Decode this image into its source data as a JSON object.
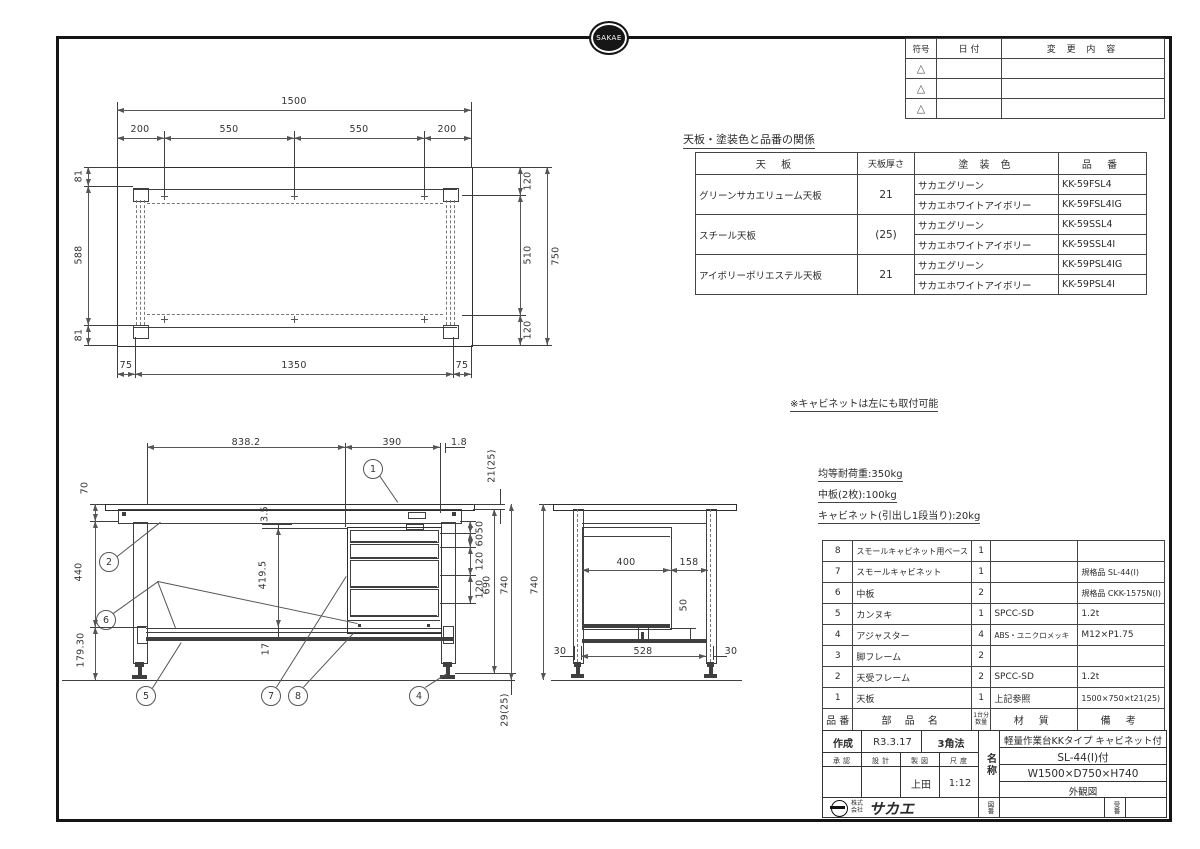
{
  "logo": {
    "text": "SAKAE",
    "company_prefix": "株式会社",
    "company_name": "サカエ"
  },
  "revision_table": {
    "col_symbol": "符号",
    "col_date": "日 付",
    "col_change": "変 更 内 容",
    "symbol": "△"
  },
  "paint_table": {
    "title": "天板・塗装色と品番の関係",
    "col_top": "天  板",
    "col_thickness": "天板厚さ",
    "col_color": "塗 装 色",
    "col_part_no": "品  番",
    "rows": [
      {
        "top_board": "グリーンサカエリューム天板",
        "thickness": "21",
        "color1": "サカエグリーン",
        "part1": "KK-59FSL4",
        "color2": "サカエホワイトアイボリー",
        "part2": "KK-59FSL4IG"
      },
      {
        "top_board": "スチール天板",
        "thickness": "(25)",
        "color1": "サカエグリーン",
        "part1": "KK-59SSL4",
        "color2": "サカエホワイトアイボリー",
        "part2": "KK-59SSL4I"
      },
      {
        "top_board": "アイボリーポリエステル天板",
        "thickness": "21",
        "color1": "サカエグリーン",
        "part1": "KK-59PSL4IG",
        "color2": "サカエホワイトアイボリー",
        "part2": "KK-59PSL4I"
      }
    ]
  },
  "notes": {
    "cabinet_note": "※キャビネットは左にも取付可能",
    "load_note1": "均等耐荷重:350kg",
    "load_note2": "中板(2枚):100kg",
    "load_note3": "キャビネット(引出し1段当り):20kg"
  },
  "parts_table": {
    "col_no": "品 番",
    "col_name": "部  品  名",
    "col_qty_top": "1台分",
    "col_qty_bottom": "数量",
    "col_material": "材  質",
    "col_remarks": "備  考",
    "rows": [
      {
        "no": "8",
        "name": "スモールキャビネット用ベース",
        "qty": "1",
        "material": "",
        "remarks": ""
      },
      {
        "no": "7",
        "name": "スモールキャビネット",
        "qty": "1",
        "material": "",
        "remarks": "規格品 SL-44(I)"
      },
      {
        "no": "6",
        "name": "中板",
        "qty": "2",
        "material": "",
        "remarks": "規格品 CKK-1575N(I)"
      },
      {
        "no": "5",
        "name": "カンヌキ",
        "qty": "1",
        "material": "SPCC-SD",
        "remarks": "1.2t"
      },
      {
        "no": "4",
        "name": "アジャスター",
        "qty": "4",
        "material": "ABS・ユニクロメッキ",
        "remarks": "M12×P1.75"
      },
      {
        "no": "3",
        "name": "脚フレーム",
        "qty": "2",
        "material": "",
        "remarks": ""
      },
      {
        "no": "2",
        "name": "天受フレーム",
        "qty": "2",
        "material": "SPCC-SD",
        "remarks": "1.2t"
      },
      {
        "no": "1",
        "name": "天板",
        "qty": "1",
        "material": "上記参照",
        "remarks": "1500×750×t21(25)"
      }
    ]
  },
  "title_block": {
    "created_label": "作成",
    "created_value": "R3.3.17",
    "projection": "3角法",
    "approve_label": "承認",
    "design_label": "設計",
    "draft_label": "製図",
    "scale_label": "尺度",
    "draft_value": "上田",
    "scale_value": "1:12",
    "name_label": "名称",
    "name_line1": "軽量作業台KKタイプ キャビネット付",
    "name_line2": "SL-44(I)付",
    "name_line3": "W1500×D750×H740",
    "name_line4": "外観図",
    "drawing_no_label": "図番",
    "order_no_label": "受番"
  },
  "top_view": {
    "dims": {
      "overall_w": "1500",
      "seg_a": "200",
      "seg_b": "550",
      "seg_c": "550",
      "seg_d": "200",
      "left_top": "81",
      "left_mid": "588",
      "left_bot": "81",
      "right_top": "120",
      "right_mid": "510",
      "right_bot": "120",
      "overall_d": "750",
      "bottom_left": "75",
      "bottom_mid": "1350",
      "bottom_right": "75"
    }
  },
  "front_view": {
    "dims": {
      "top_a": "838.2",
      "top_b": "390",
      "top_c": "1.8",
      "thickness": "21(25)",
      "apron": "70",
      "leg": "440",
      "lower": "179.30",
      "gap": "3.5",
      "cabinet": "419.5",
      "shelf": "17",
      "d1": "50",
      "d2": "60",
      "d3": "120",
      "d4": "120",
      "underside": "690",
      "height": "740",
      "adjuster": "29(25)"
    },
    "balloons": {
      "b1": "1",
      "b2": "2",
      "b4": "4",
      "b5": "5",
      "b6": "6",
      "b7": "7",
      "b8": "8"
    }
  },
  "side_view": {
    "dims": {
      "height": "740",
      "cab_depth": "400",
      "rear": "158",
      "shelf_gap": "50",
      "left": "30",
      "mid": "528",
      "right": "30"
    }
  }
}
